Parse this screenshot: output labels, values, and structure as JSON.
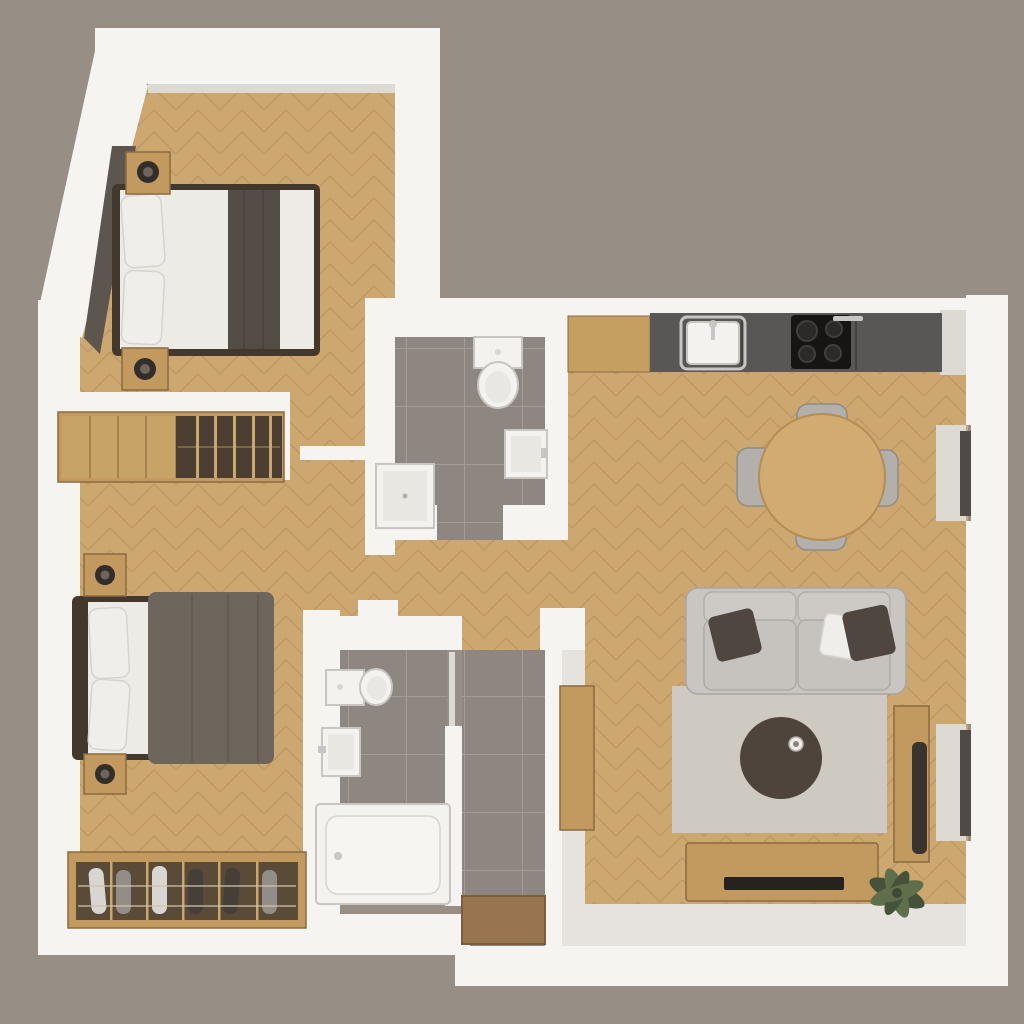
{
  "scene": {
    "title": "3D top-down render of a two-bedroom apartment floor plan",
    "style": "white walls, oak chevron parquet floors, grey tiled wet rooms",
    "windows_on_right_wall": 2,
    "visible_text": ""
  },
  "palette": {
    "background": "#978e86",
    "wall": "#f6f4f1",
    "wallShade": "#ddd9d3",
    "floorWood": "#cda770",
    "floorWoodLine": "#a8834f",
    "floorLight": "#e6e3de",
    "tile": "#8e8680",
    "tileLine": "#a69e97",
    "counterWood": "#c59f62",
    "counterDark": "#595755",
    "counterSeam": "#44423f",
    "cooktop": "#161514",
    "burner": "#2b2a29",
    "chrome": "#c7c6c4",
    "fixtureWhite": "#f3f2ef",
    "fixtureStroke": "#c9c5c0",
    "sofa": "#c9c5c0",
    "sofaLine": "#a9a5a0",
    "rug": "#cec9c1",
    "pillowDark": "#4e463f",
    "pillowWhite": "#f0eeea",
    "tableWood": "#d2ab73",
    "chairGray": "#b3afaa",
    "chairShade": "#8f8b86",
    "coffeeTable": "#4e443b",
    "woodFurniture": "#c29a5f",
    "woodFurnitureDark": "#8a6b41",
    "wardrobeOpen": "#4c3f31",
    "wardrobeDivider": "#c9a76d",
    "bedFrameDark": "#43382e",
    "duvetWhite": "#edebe6",
    "runnerDark": "#544d46",
    "duvetGray": "#6e655d",
    "lampDark": "#332e29",
    "benchInterior": "#5a4a38",
    "shoeWhite": "#d9d6d1",
    "shoeGray": "#928d86",
    "shoeDark": "#453f38",
    "matBrown": "#987550",
    "plantGreen": "#5f6f4c",
    "plantDark": "#44523a",
    "glassDark": "#4f4a45",
    "headboardWedge": "#5d564f"
  },
  "rooms": [
    {
      "id": "bedroom-1",
      "name": "Bedroom 1 (top-left, slanted wall)",
      "floor": "oak chevron parquet",
      "furniture": [
        "double bed with white duvet and dark grey runner",
        "two white pillows",
        "dark headboard panel along slanted wall",
        "two wooden nightstands with dark lamps"
      ]
    },
    {
      "id": "wardrobe-niche",
      "name": "Wardrobe niche",
      "floor": "oak chevron parquet",
      "furniture": [
        "wardrobe with wooden doors",
        "open shelving compartment with dividers"
      ]
    },
    {
      "id": "bedroom-2",
      "name": "Bedroom 2 (bottom-left)",
      "floor": "oak chevron parquet",
      "furniture": [
        "double bed with grey duvet and white pillows",
        "two wooden nightstands with dark lamps",
        "shoe bench with rails and shoes"
      ]
    },
    {
      "id": "wc",
      "name": "WC (top-centre)",
      "floor": "grey tile",
      "furniture": [
        "toilet",
        "wall-hung wash basin",
        "shower tray"
      ]
    },
    {
      "id": "bathroom",
      "name": "Bathroom (centre-bottom)",
      "floor": "grey tile",
      "furniture": [
        "toilet",
        "wash basin",
        "bathtub"
      ]
    },
    {
      "id": "hallway",
      "name": "Hallway (centre)",
      "floor": "oak chevron parquet",
      "furniture": []
    },
    {
      "id": "entry",
      "name": "Entry corridor (bottom-centre)",
      "floor": "grey tile",
      "furniture": [
        "wooden door mat"
      ]
    },
    {
      "id": "living-room",
      "name": "Living room with kitchen (right)",
      "floor": "oak chevron parquet",
      "furniture": [
        "kitchen counter with sink",
        "black cooktop with four burners",
        "round wooden dining table",
        "four grey chairs",
        "grey two-seat sofa with dark and white cushions",
        "light grey rug",
        "round dark coffee table with cup",
        "wooden sideboard",
        "media console with TV soundbar",
        "tall wooden cabinet with dark speaker",
        "green plant"
      ]
    }
  ]
}
